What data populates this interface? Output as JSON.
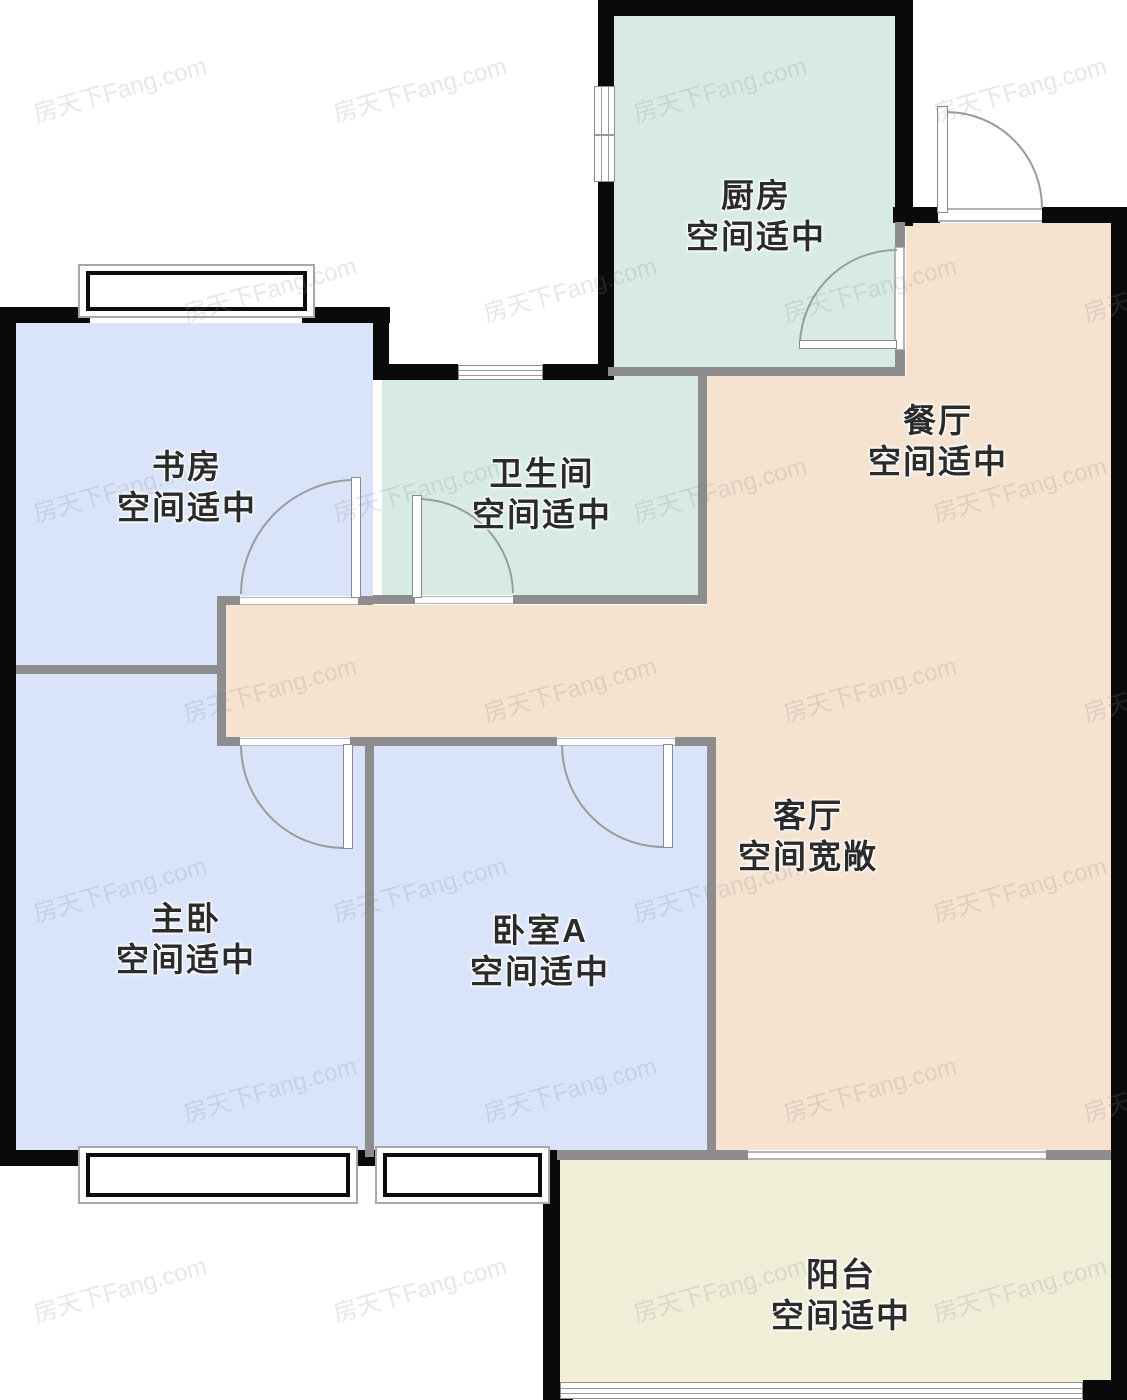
{
  "watermark": "房天下Fang.com",
  "palette": {
    "wall_exterior": "#0a0a0a",
    "wall_interior": "#8d8d8d",
    "kitchen_fill": "#d7ebe4",
    "bathroom_fill": "#d7ebe4",
    "bedroom_fill": "#d9e4fa",
    "living_fill": "#f5e2cf",
    "balcony_fill": "#f0eed7",
    "label_color": "#2b2b2b"
  },
  "rooms": [
    {
      "id": "kitchen",
      "name": "厨房",
      "note": "空间适中",
      "label_x": 756,
      "label_y": 216
    },
    {
      "id": "dining",
      "name": "餐厅",
      "note": "空间适中",
      "label_x": 938,
      "label_y": 441
    },
    {
      "id": "study",
      "name": "书房",
      "note": "空间适中",
      "label_x": 187,
      "label_y": 487
    },
    {
      "id": "bathroom",
      "name": "卫生间",
      "note": "空间适中",
      "label_x": 542,
      "label_y": 494
    },
    {
      "id": "master-bedroom",
      "name": "主卧",
      "note": "空间适中",
      "label_x": 186,
      "label_y": 939
    },
    {
      "id": "bedroom-a",
      "name": "卧室A",
      "note": "空间适中",
      "label_x": 540,
      "label_y": 951
    },
    {
      "id": "living-room",
      "name": "客厅",
      "note": "空间宽敞",
      "label_x": 808,
      "label_y": 836
    },
    {
      "id": "balcony",
      "name": "阳台",
      "note": "空间适中",
      "label_x": 841,
      "label_y": 1295
    }
  ]
}
